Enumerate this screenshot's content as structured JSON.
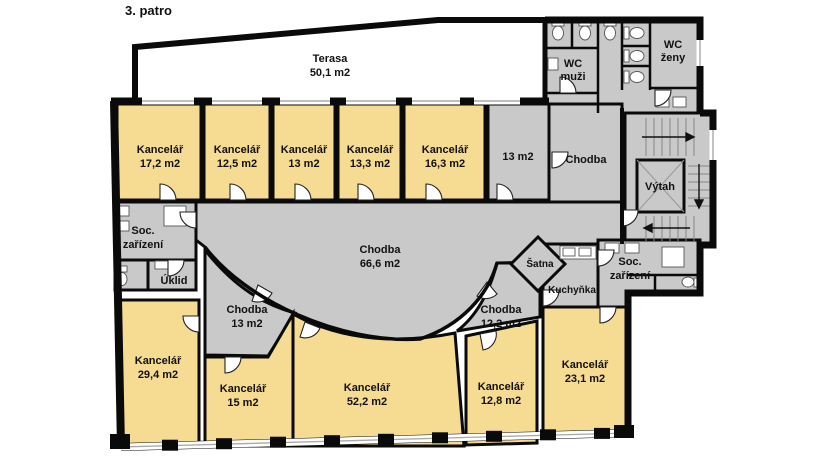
{
  "title": "3. patro",
  "colors": {
    "office": "#F6DB92",
    "common": "#C9C9C9",
    "shaft": "#FFFFFF",
    "terrace": "#FFFFFF",
    "wall": "#0a0a0a"
  },
  "rooms": {
    "terasa": {
      "name": "Terasa",
      "area": "50,1 m2"
    },
    "kancelar_17_2": {
      "name": "Kancelář",
      "area": "17,2 m2"
    },
    "kancelar_12_5": {
      "name": "Kancelář",
      "area": "12,5 m2"
    },
    "kancelar_13": {
      "name": "Kancelář",
      "area": "13 m2"
    },
    "kancelar_13_3": {
      "name": "Kancelář",
      "area": "13,3 m2"
    },
    "kancelar_16_3": {
      "name": "Kancelář",
      "area": "16,3 m2"
    },
    "mistnost_13": {
      "area": "13 m2"
    },
    "chodba_horni": {
      "name": "Chodba"
    },
    "wc_muzi": {
      "name": "WC",
      "name2": "muži"
    },
    "wc_zeny": {
      "name": "WC",
      "name2": "ženy"
    },
    "vytah": {
      "name": "Výtah"
    },
    "soc_zarizeni_left": {
      "name": "Soc.",
      "name2": "zařízení"
    },
    "uklid": {
      "name": "Úklid"
    },
    "chodba_hlavni": {
      "name": "Chodba",
      "area": "66,6 m2"
    },
    "satna": {
      "name": "Šatna"
    },
    "kuchynka": {
      "name": "Kuchyňka"
    },
    "soc_zarizeni_right": {
      "name": "Soc.",
      "name2": "zařízení"
    },
    "chodba_13": {
      "name": "Chodba",
      "area": "13 m2"
    },
    "kancelar_29_4": {
      "name": "Kancelář",
      "area": "29,4 m2"
    },
    "kancelar_15": {
      "name": "Kancelář",
      "area": "15 m2"
    },
    "kancelar_52_2": {
      "name": "Kancelář",
      "area": "52,2 m2"
    },
    "chodba_12_2": {
      "name": "Chodba",
      "area": "12,2 m2"
    },
    "kancelar_12_8": {
      "name": "Kancelář",
      "area": "12,8 m2"
    },
    "kancelar_23_1": {
      "name": "Kancelář",
      "area": "23,1 m2"
    }
  }
}
